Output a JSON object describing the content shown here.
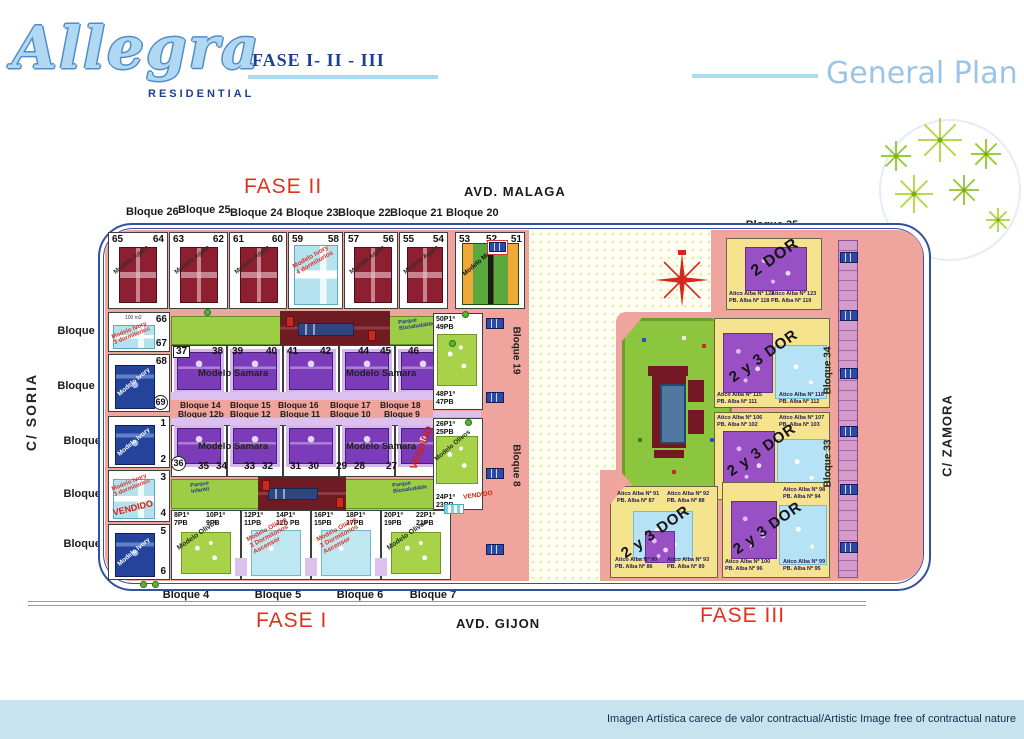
{
  "header": {
    "logo": "Allegra",
    "logo_sub": "RESIDENTIAL",
    "phases": "FASE I- II - III",
    "title": "General Plan"
  },
  "streets": {
    "top": "AVD. MALAGA",
    "bottom": "AVD. GIJON",
    "left": "C/ SORIA",
    "right": "C/ ZAMORA"
  },
  "phase_labels": {
    "f1": "FASE I",
    "f2": "FASE II",
    "f3": "FASE III"
  },
  "bloques": {
    "top": [
      "Bloque 26",
      "Bloque 25",
      "Bloque 24",
      "Bloque 23",
      "Bloque 22",
      "Bloque 21",
      "Bloque 20"
    ],
    "left": [
      "Bloque 27",
      "Bloque 28",
      "Bloque 1",
      "Bloque 2",
      "Bloque 3"
    ],
    "bottom": [
      "Bloque 4",
      "Bloque 5",
      "Bloque 6",
      "Bloque 7"
    ],
    "bottom_right": [
      "Bloque 31",
      "Bloque 32"
    ],
    "right_top": "Bloque 35",
    "col34": "Bloque 34",
    "col33": "Bloque 33",
    "col19": "Bloque 19",
    "col8": "Bloque 8",
    "samara_row1": [
      "Bloque 14",
      "Bloque 15",
      "Bloque 16",
      "Bloque 17",
      "Bloque 18"
    ],
    "samara_row2": [
      "Bloque 12b",
      "Bloque 12",
      "Bloque 11",
      "Bloque 10",
      "Bloque 9"
    ]
  },
  "plots": {
    "top": [
      "65",
      "64",
      "63",
      "62",
      "61",
      "60",
      "59",
      "58",
      "57",
      "56",
      "55",
      "54",
      "53",
      "52",
      "51"
    ],
    "left_col": [
      "66",
      "67",
      "68",
      "69",
      "1",
      "2",
      "3",
      "4",
      "5",
      "6"
    ],
    "samara_top": [
      "37",
      "38",
      "39",
      "40",
      "41",
      "42",
      "44",
      "45",
      "46"
    ],
    "samara_bottom": [
      "36",
      "35",
      "34",
      "33",
      "32",
      "31",
      "30",
      "29",
      "28",
      "27"
    ],
    "area_note": "100 m2"
  },
  "units": {
    "olivos": [
      "8P1ª\n7PB",
      "10P1ª\n9PB",
      "12P1ª\n11PB",
      "14P1ª\n12b PB",
      "16P1ª\n15PB",
      "18P1ª\n17PB",
      "20P1ª\n19PB",
      "22P1ª\n21PB"
    ],
    "side": [
      "50P1ª\n49PB",
      "48P1ª\n47PB",
      "26P1ª\n25PB",
      "24P1ª\n23PB"
    ]
  },
  "models": {
    "agata": "Modelo Agata",
    "ivory": "Modelo Ivory",
    "ivory3": "Modelo Ivory\n3 dormitorios",
    "ivory4": "Modelo Ivory\n4 dormitorios",
    "samara": "Modelo Samara",
    "olivos": "Modelo Olivos",
    "olivos3": "Modelo Olivos\n3 Dormitorios\nAscensor",
    "manzana": "Modelo Manzana"
  },
  "status": {
    "vendido": "VENDIDO"
  },
  "parks": {
    "infantil": "Parque\nInfantil",
    "bio": "Parque\nBiosaludable"
  },
  "fase3": {
    "dor2": "2 DOR",
    "dor23": "2 y 3 DOR",
    "aticos": [
      "Atico Alba Nº 122\nPB. Alba Nº 118",
      "Atico Alba Nº 123\nPB. Alba Nº 119",
      "Atico Alba Nº 115\nPB. Alba Nº 111",
      "Atico Alba Nº 116\nPB. Alba Nº 112",
      "Atico Alba Nº 106\nPB. Alba Nº 102",
      "Atico Alba Nº 107\nPB. Alba Nº 103",
      "Atico Alba Nº 108\nPB. Alba Nº 104",
      "Atico Alba Nº 91\nPB. Alba Nº 87",
      "Atico Alba Nº 92\nPB. Alba Nº 88",
      "Atico Alba Nº 90\nPB. Alba Nº 86",
      "Atico Alba Nº 93\nPB. Alba Nº 89",
      "Atico Alba Nº 100\nPB. Alba Nº 96",
      "Atico Alba Nº 98\nPB. Alba Nº 94",
      "Atico Alba Nº 99\nPB. Alba Nº 95"
    ]
  },
  "footer": {
    "disclaimer": "Imagen Artística carece de valor contractual/Artistic Image free of contractual nature"
  },
  "colors": {
    "accent_red": "#e0301e",
    "brand_blue": "#1c3f94",
    "light_blue": "#a9d3ee",
    "road_pink": "#efa59d",
    "park_green": "#9ccd45",
    "fase3_yellow": "#f5e38e",
    "building_red": "#8d1f30",
    "samara_purple": "#7c3cb9",
    "olivos_green": "#a8d24a",
    "ivory_cyan": "#b4e3ef",
    "ivory_blue": "#24449c"
  }
}
